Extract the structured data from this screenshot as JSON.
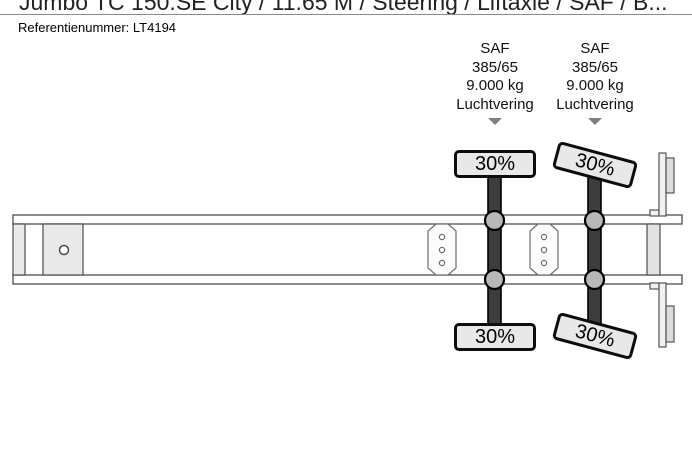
{
  "header": {
    "title": "Jumbo TC 150.SE City / 11.65 M / Steering / Liftaxle / SAF / B...",
    "reference_label": "Referentienummer:",
    "reference_value": "LT4194"
  },
  "axles": [
    {
      "brand": "SAF",
      "tire_size": "385/65",
      "axle_load": "9.000 kg",
      "suspension": "Luchtvering",
      "wheel_top": "30%",
      "wheel_bottom": "30%"
    },
    {
      "brand": "SAF",
      "tire_size": "385/65",
      "axle_load": "9.000 kg",
      "suspension": "Luchtvering",
      "wheel_top": "30%",
      "wheel_bottom": "30%"
    }
  ],
  "colors": {
    "axle_shaft": "#3d3d3d",
    "wheel_fill": "#e8e8e8",
    "frame_outline": "#4d4d4d",
    "panel_fill": "#e9e9e9",
    "arrow": "#808080"
  }
}
